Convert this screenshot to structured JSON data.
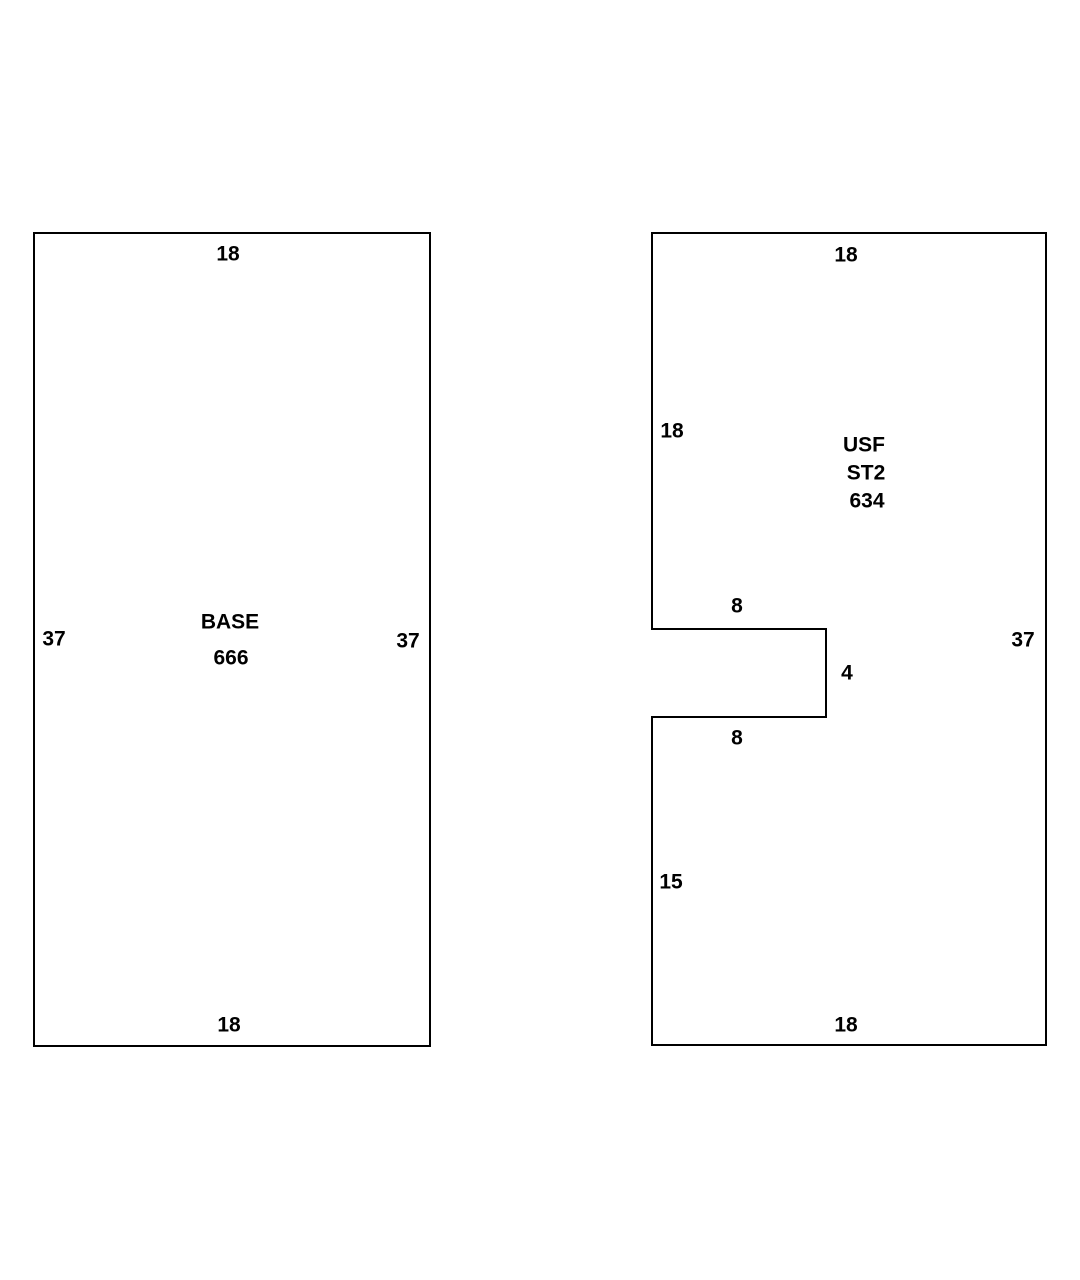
{
  "sketch": {
    "base": {
      "name": "BASE",
      "area": "666",
      "dims": {
        "top": "18",
        "left": "37",
        "right": "37",
        "bottom": "18"
      }
    },
    "usf": {
      "name_line1": "USF",
      "name_line2": "ST2",
      "area": "634",
      "dims": {
        "top": "18",
        "upper_left": "18",
        "notch_top": "8",
        "notch_right": "4",
        "notch_bottom": "8",
        "lower_left": "15",
        "right": "37",
        "bottom": "18"
      }
    },
    "colors": {
      "background": "#ffffff",
      "outline": "#000000",
      "text": "#000000"
    }
  }
}
